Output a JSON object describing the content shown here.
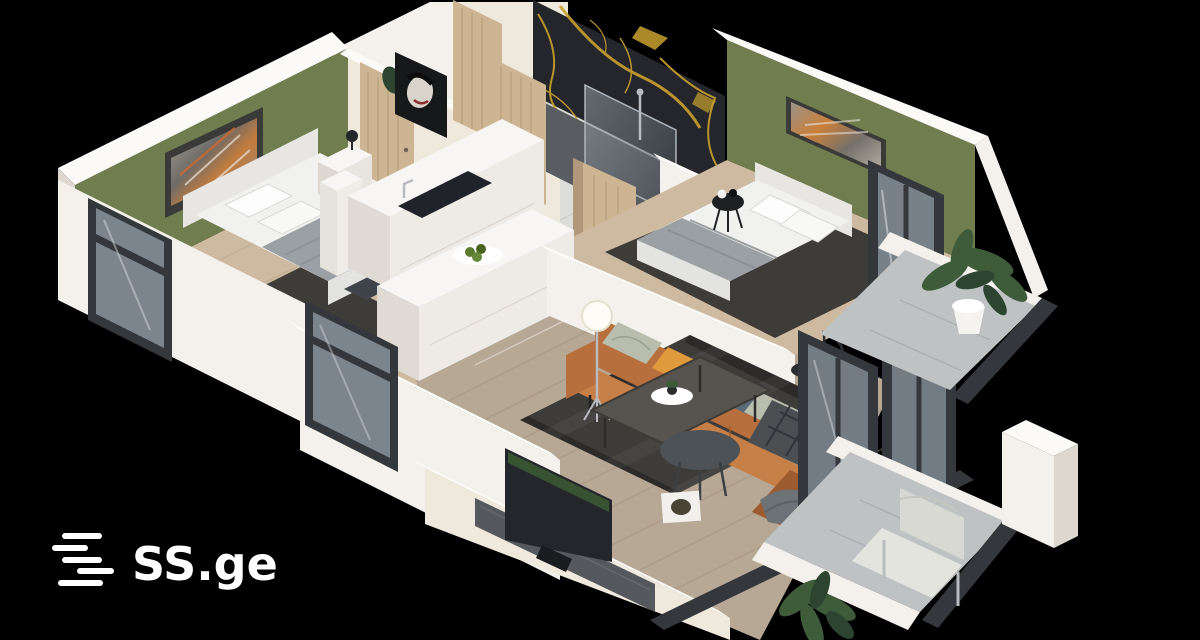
{
  "brand": {
    "logo_text": "SS.ge",
    "logo_icon": "ss-stripes-icon"
  },
  "colors": {
    "background": "#000000",
    "wall_white": "#f4f1ec",
    "wall_white_bright": "#fbfaf7",
    "wall_white_shade": "#ddd7cf",
    "wall_cream": "#efe8dd",
    "wall_green": "#6f7d4f",
    "wall_green_shade": "#5e6b43",
    "marble_black": "#25262b",
    "marble_gold": "#c9a12f",
    "door_wood": "#cdb594",
    "door_wood_edge": "#b2987a",
    "floor_wood_bedroom": "#cdbaa1",
    "floor_wood_living": "#b7a795",
    "floor_tile": "#dcdcda",
    "floor_tile_bath": "#595c60",
    "balcony_floor": "#bfc2c3",
    "rug_dark": "#3d3c39",
    "bed_white": "#f1f1f0",
    "headboard_gray": "#e7e6e3",
    "blanket_gray": "#9aa0a4",
    "sofa_leather": "#b76f3d",
    "sofa_leather_light": "#c77f48",
    "sofa_leather_dark": "#9c5c30",
    "pillow_orange": "#e09a3e",
    "pillow_sage": "#b9bdae",
    "pillow_navy": "#5b6a77",
    "throw_plaid": "#4b4f52",
    "frame_dark": "#34383c",
    "glass_tint": "#8a939b",
    "furniture_dark": "#55595e",
    "table_brown": "#57534e",
    "plant_green": "#3e5b3a",
    "plant_green_dark": "#2c4430",
    "chrome": "#b8bcc0",
    "logo_white": "#ffffff"
  }
}
